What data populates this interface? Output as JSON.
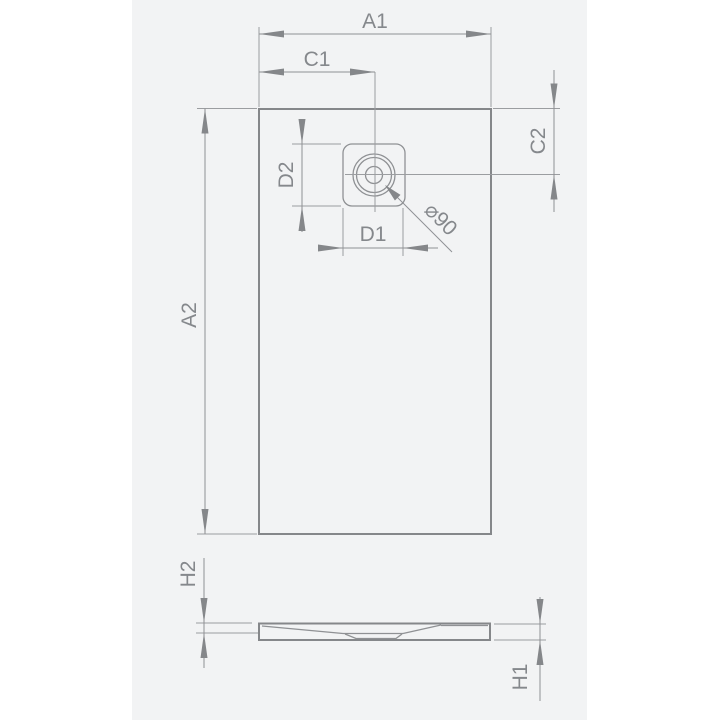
{
  "figure": {
    "labels": {
      "a1": "A1",
      "c1": "C1",
      "c2": "C2",
      "d2": "D2",
      "d1": "D1",
      "a2": "A2",
      "diameter": "⌀90",
      "h2": "H2",
      "h1": "H1"
    },
    "colors": {
      "page_background": "#ffffff",
      "panel_background": "#f2f3f4",
      "line": "#8f9194",
      "text": "#85888c"
    }
  }
}
